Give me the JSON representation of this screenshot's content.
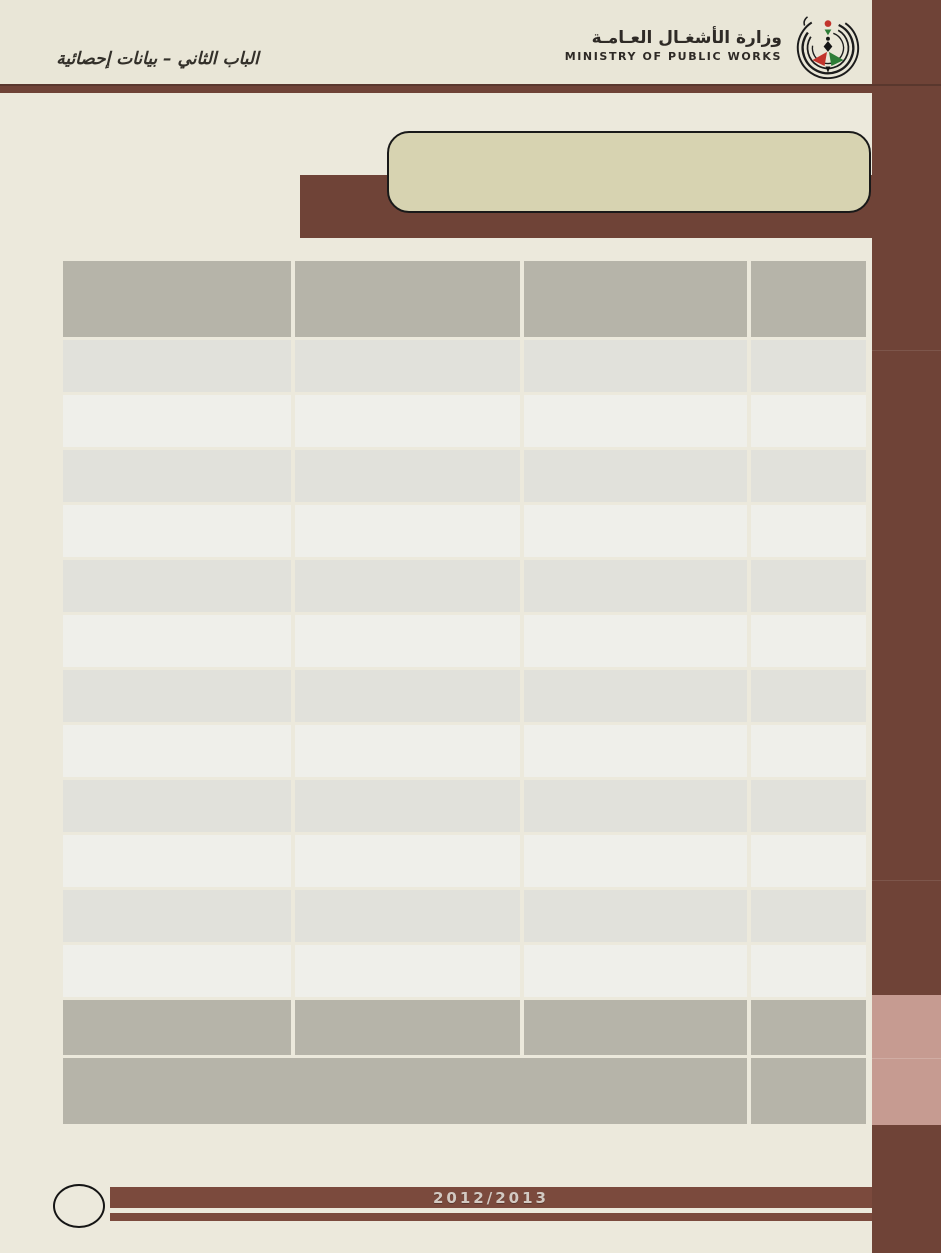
{
  "page": {
    "chapter_title": "الباب الثاني – بيانات إحصائية",
    "year_label": "2012/2013",
    "page_number": ""
  },
  "header": {
    "ministry_name_ar": "وزارة الأشغـال العـامـة",
    "ministry_name_en": "MINISTRY OF PUBLIC WORKS",
    "logo_icon": "ministry-swirl-logo"
  },
  "title_banner": {
    "text": ""
  },
  "table": {
    "columns": [
      "",
      "",
      "",
      ""
    ],
    "rows": [
      [
        "",
        "",
        "",
        ""
      ],
      [
        "",
        "",
        "",
        ""
      ],
      [
        "",
        "",
        "",
        ""
      ],
      [
        "",
        "",
        "",
        ""
      ],
      [
        "",
        "",
        "",
        ""
      ],
      [
        "",
        "",
        "",
        ""
      ],
      [
        "",
        "",
        "",
        ""
      ],
      [
        "",
        "",
        "",
        ""
      ],
      [
        "",
        "",
        "",
        ""
      ],
      [
        "",
        "",
        "",
        ""
      ],
      [
        "",
        "",
        "",
        ""
      ],
      [
        "",
        "",
        "",
        ""
      ]
    ],
    "footer_rows": [
      {
        "cells": [
          "",
          "",
          "",
          ""
        ],
        "spans": [
          1,
          1,
          1,
          1
        ]
      },
      {
        "cells": [
          "",
          ""
        ],
        "spans": [
          3,
          1
        ]
      }
    ]
  },
  "colors": {
    "page_background": "#ECE9DC",
    "maroon": "#6F4337",
    "footer_bar_maroon": "#7B4A3D",
    "title_box_fill": "#D7D3B1",
    "table_header_gray": "#B6B4A9",
    "table_row_dark": "#E1E1DB",
    "table_row_light": "#EFEFEA",
    "sidebar_accent_pink": "#C69B91",
    "year_text": "#D3C9C2"
  }
}
